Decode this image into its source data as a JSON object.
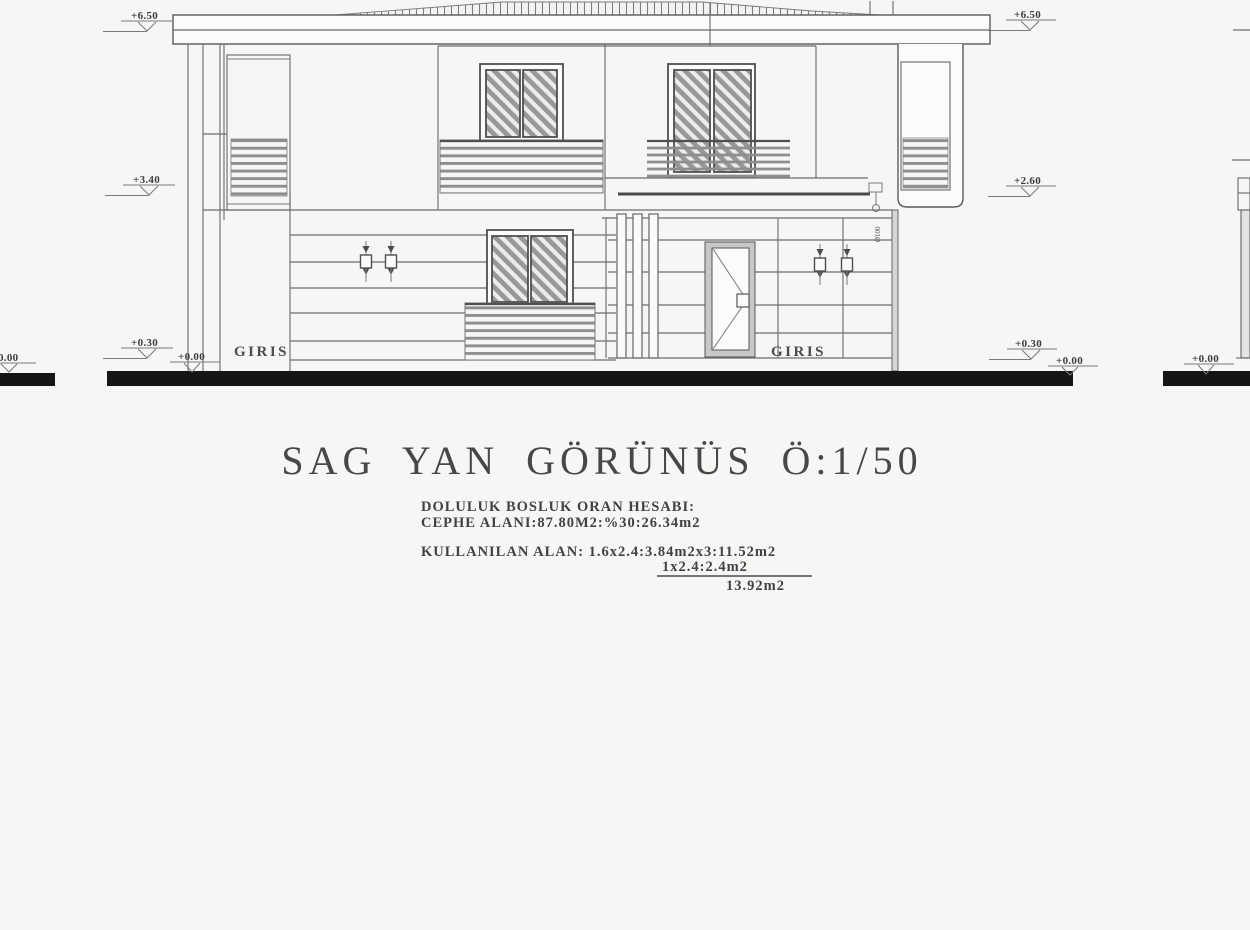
{
  "drawing_title": "SAG YAN GÖRÜNÜS Ö:1/50",
  "calc": {
    "heading": "DOLULUK BOSLUK ORAN HESABI:",
    "facade_area": "CEPHE ALANI:87.80M2:%30:26.34m2",
    "used_area": "KULLANILAN ALAN: 1.6x2.4:3.84m2x3:11.52m2",
    "used_area_2": "1x2.4:2.4m2",
    "total": "13.92m2"
  },
  "labels": {
    "entrance_left": "GIRIS",
    "entrance_right": "GIRIS",
    "pipe_note": "Ø100"
  },
  "markers": {
    "left": [
      "+6.50",
      "+3.40",
      "+0.30",
      "+0.00",
      "-0.00"
    ],
    "right": [
      "+6.50",
      "+2.60",
      "+0.30",
      "+0.00",
      "+0.00"
    ]
  },
  "colors": {
    "background": "#f6f6f5",
    "line": "#6e6e6e",
    "dark_line": "#4f4f4f",
    "ground": "#151515",
    "text": "#3c3c3c"
  }
}
